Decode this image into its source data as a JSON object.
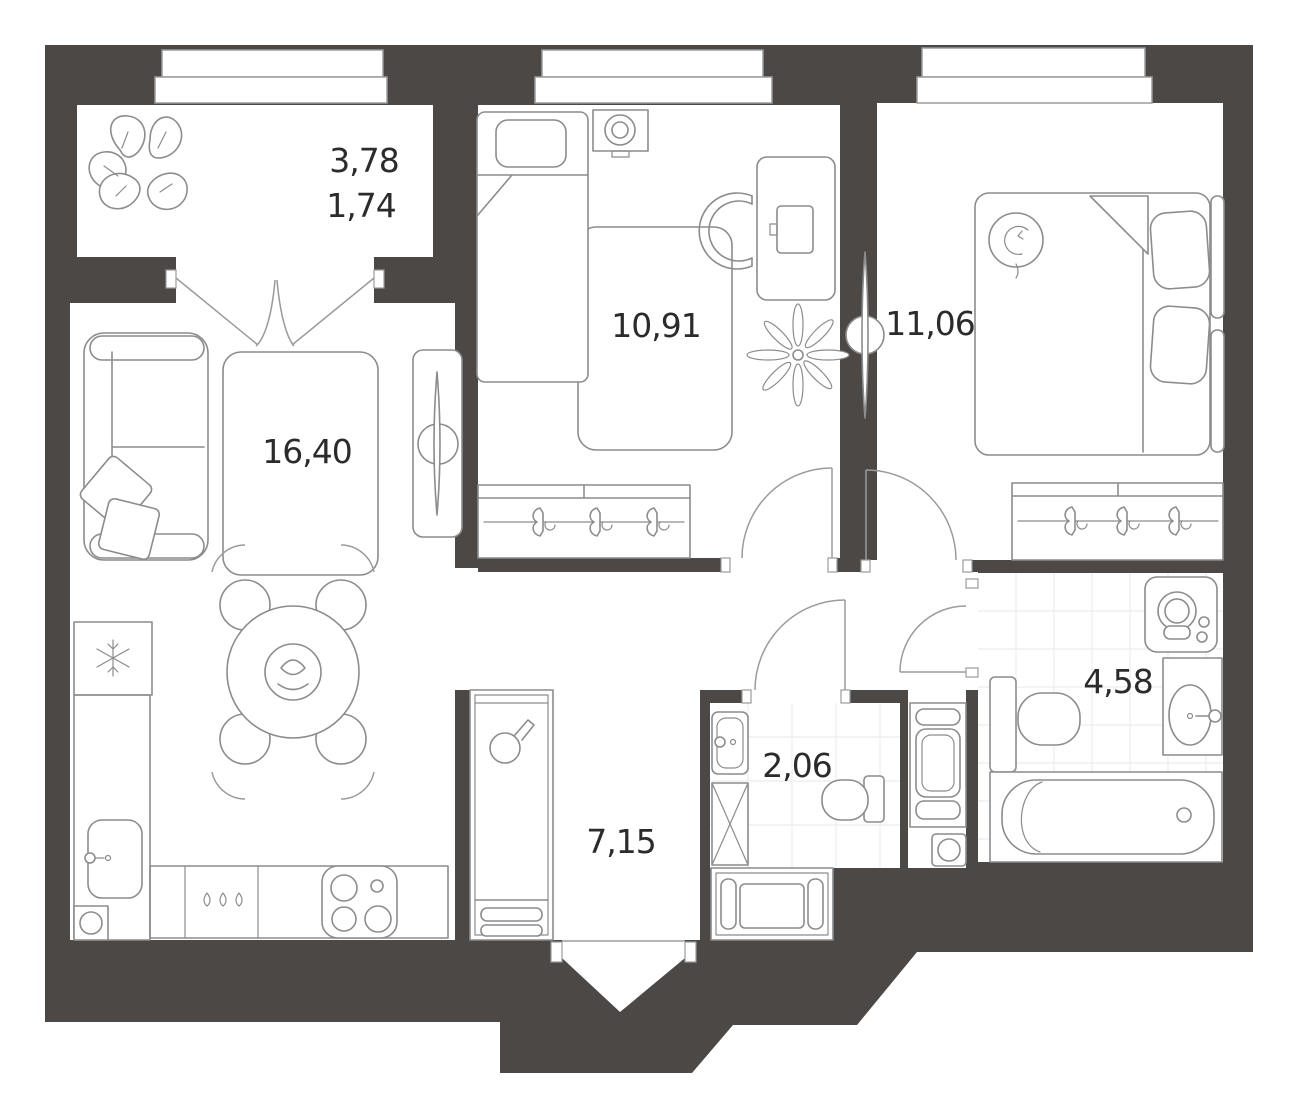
{
  "plan": {
    "colors": {
      "wall": "#4b4846",
      "line": "#8c8c8c",
      "tile": "#ececec",
      "door": "#9b9b9b",
      "text": "#2b2b2b"
    },
    "rooms": {
      "loggia": {
        "area_total": "3,78",
        "area_reduced": "1,74"
      },
      "living_kitchen": {
        "area": "16,40"
      },
      "bedroom_small": {
        "area": "10,91"
      },
      "bedroom_master": {
        "area": "11,06"
      },
      "hallway": {
        "area": "7,15"
      },
      "wc": {
        "area": "2,06"
      },
      "bathroom": {
        "area": "4,58"
      }
    }
  }
}
